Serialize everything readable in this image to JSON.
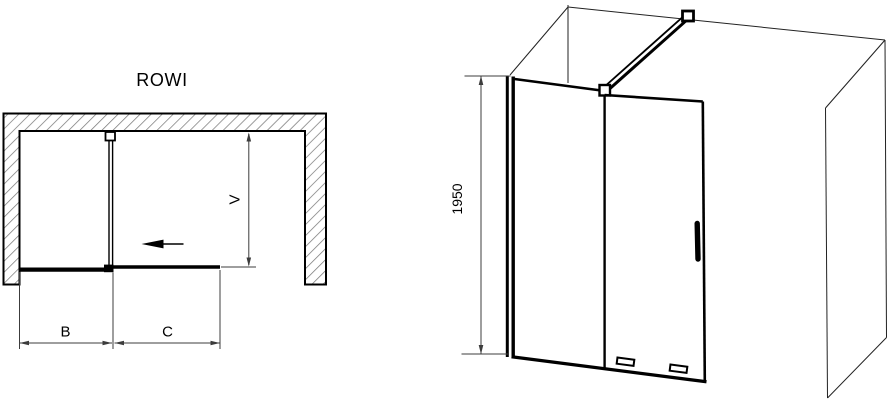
{
  "diagram": {
    "product_name": "ROWI",
    "colors": {
      "line": "#000000",
      "hatch": "#7b7b7b",
      "dimension": "#3c3c3c",
      "bg": "#ffffff"
    },
    "plan_view": {
      "labels": {
        "fixed_panel_width": "B",
        "sliding_door_width": "C",
        "entry_depth": "V"
      }
    },
    "perspective_view": {
      "labels": {
        "height": "1950"
      }
    }
  }
}
